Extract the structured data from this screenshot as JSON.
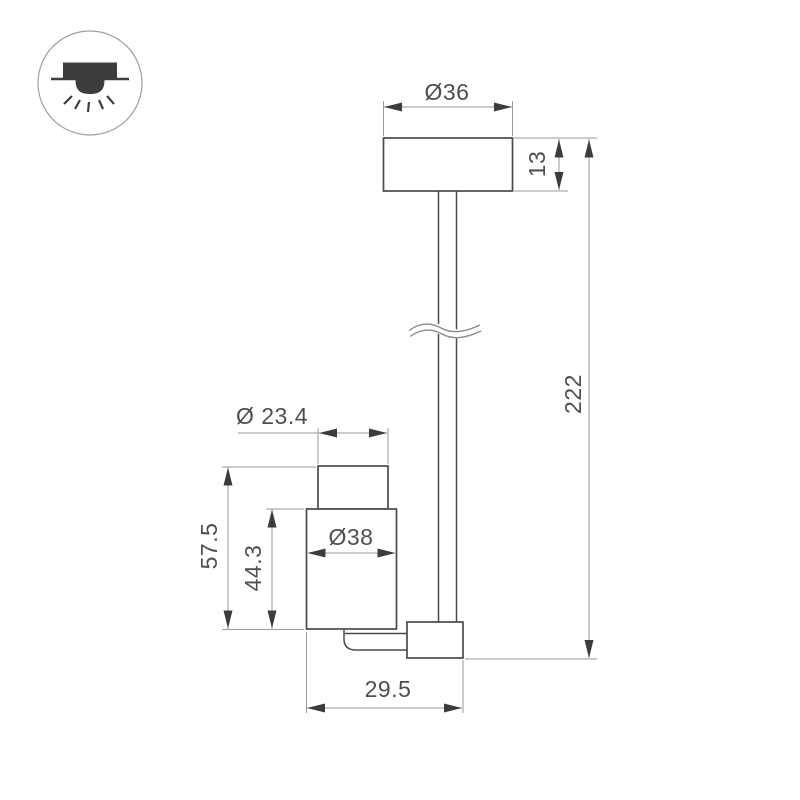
{
  "drawing": {
    "type": "technical-dimension-drawing",
    "product": "ceiling surface-mounted spot luminaire on suspension rod",
    "badge": {
      "icon": "surface-mounted-downlight-icon"
    },
    "colors": {
      "background": "#ffffff",
      "object_line": "#4a4a4a",
      "dimension_line": "#9a9a9a",
      "arrow": "#3c3c3c",
      "text": "#4f4f4f",
      "badge_outline": "#9e9e9e",
      "icon": "#3d3d3d"
    },
    "dimensions": {
      "canopy_diameter": "Ø36",
      "canopy_height": "13",
      "suspension_length": "222",
      "head_top_diameter": "Ø 23.4",
      "head_body_diameter": "Ø38",
      "head_total_height": "57.5",
      "head_body_height": "44.3",
      "base_width": "29.5"
    }
  }
}
